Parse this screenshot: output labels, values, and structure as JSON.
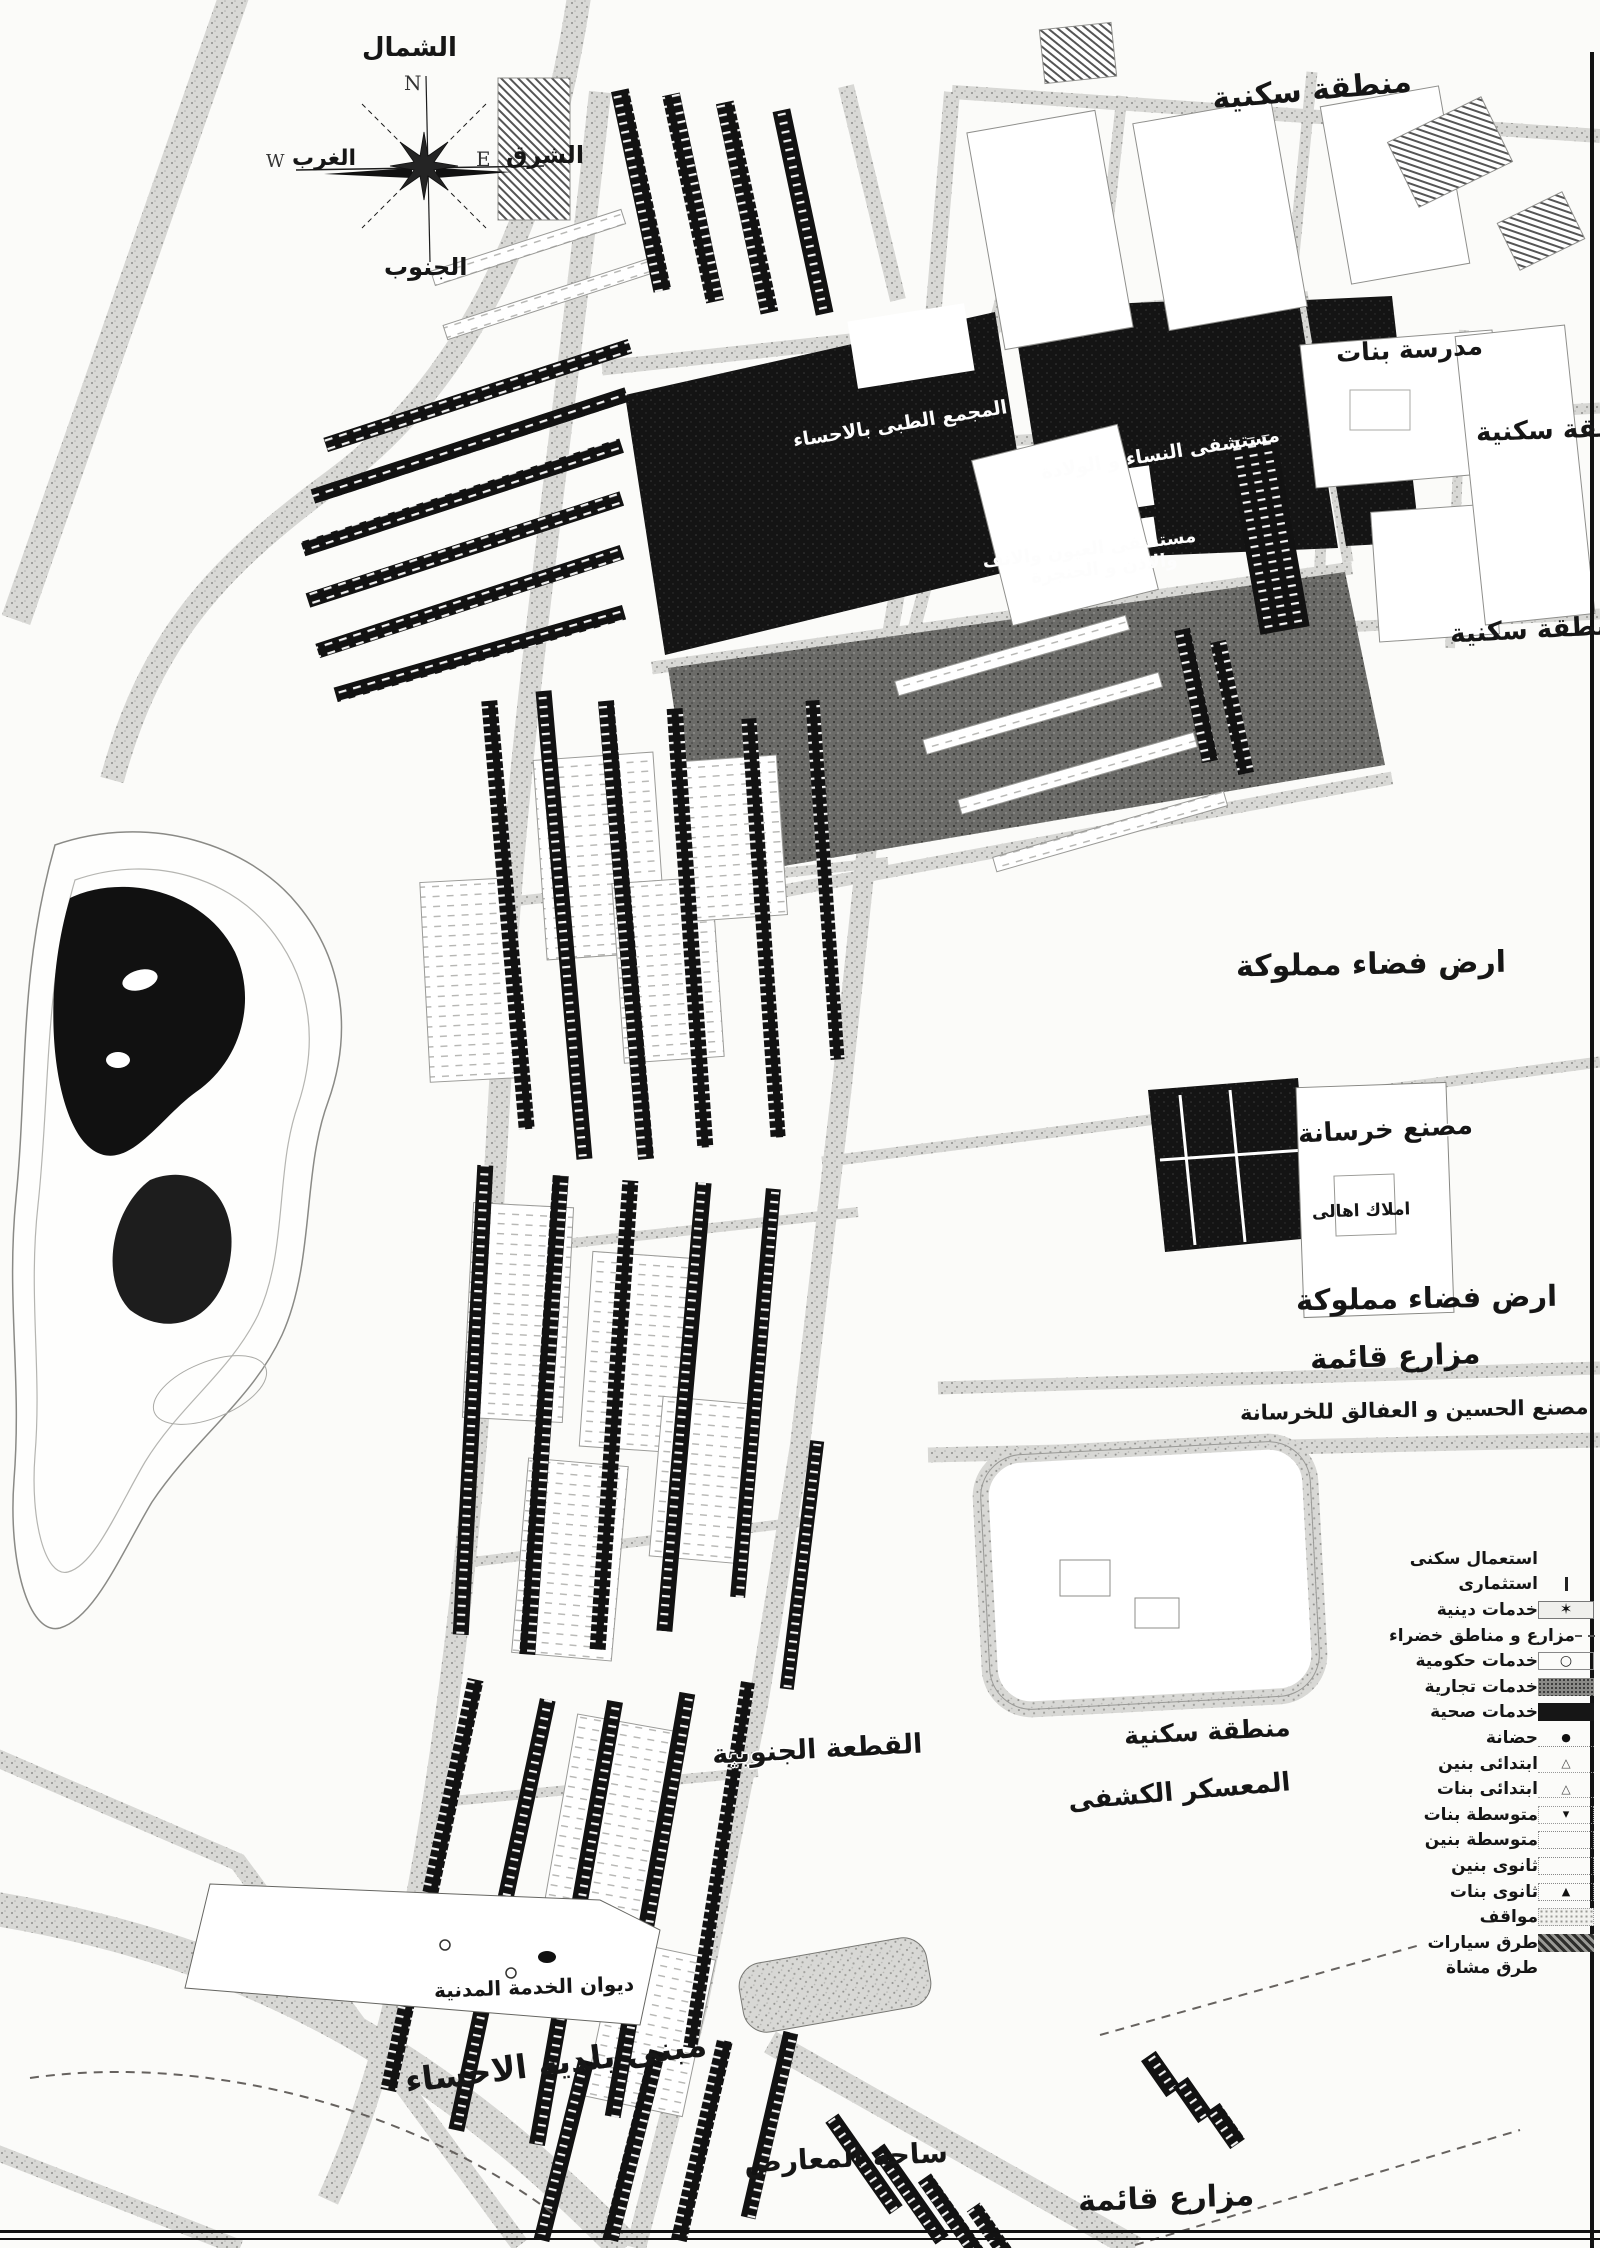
{
  "compass": {
    "north": "الشمال",
    "north_letter": "N",
    "east": "الشرق",
    "east_letter": "E",
    "west": "الغرب",
    "west_letter": "W",
    "south": "الجنوب"
  },
  "labels": {
    "residential_top": "منطقة سكنية",
    "girls_school": "مدرسة بنات",
    "residential_right_upper": "منطقة سكنية",
    "residential_right_lower": "منطقة سكنية",
    "medical_complex": "المجمع الطبى بالاحساء",
    "maternity_hospital": "مستشفى النساء و الولادة",
    "eye_ent_hospital_line1": "مستشفى العيون والانف",
    "eye_ent_hospital_line2": "والاذن و الحنجرة",
    "owned_vacant_land_upper": "ارض فضاء مملوكة",
    "concrete_factory": "مصنع خرسانة",
    "private_properties": "املاك اهالى",
    "owned_vacant_land_lower": "ارض فضاء مملوكة",
    "existing_farms_upper": "مزارع قائمة",
    "hussein_concrete_factory": "مصنع الحسين و العفالق للخرسانة",
    "residential_middle": "منطقة سكنية",
    "scout_camp": "المعسكر الكشفى",
    "southern_parcel": "القطعة الجنوبية",
    "civil_service_bureau": "ديوان الخدمة المدنية",
    "municipality_building": "مبنى بلدية الاحساء",
    "exhibition_grounds": "ساحة المعارض",
    "existing_farms_lower": "مزارع قائمة"
  },
  "legend": {
    "items": [
      {
        "label": "استعمال سكنى",
        "symbol": "blank"
      },
      {
        "label": "استثمارى",
        "symbol": "tick"
      },
      {
        "label": "خدمات دينية",
        "symbol": "mosque-star"
      },
      {
        "label": "مزارع و مناطق خضراء",
        "symbol": "dashed"
      },
      {
        "label": "خدمات حكومية",
        "symbol": "circle"
      },
      {
        "label": "خدمات تجارية",
        "symbol": "dark-speckle"
      },
      {
        "label": "خدمات صحية",
        "symbol": "black"
      },
      {
        "label": "حضانة",
        "symbol": "dot"
      },
      {
        "label": "ابتدائى بنين",
        "symbol": "triangle-outline"
      },
      {
        "label": "ابتدائى بنات",
        "symbol": "triangle-outline"
      },
      {
        "label": "متوسطة بنات",
        "symbol": "triangle-small"
      },
      {
        "label": "متوسطة بنين",
        "symbol": "dotted-rect"
      },
      {
        "label": "ثانوى بنين",
        "symbol": "dotted-rect"
      },
      {
        "label": "ثانوى بنات",
        "symbol": "triangle-filled"
      },
      {
        "label": "مواقف",
        "symbol": "speckle-light"
      },
      {
        "label": "طرق سيارات",
        "symbol": "hatch-heavy"
      },
      {
        "label": "طرق مشاة",
        "symbol": "blank"
      }
    ]
  },
  "colors": {
    "ink": "#141414",
    "road_gray": "#c9c9c6",
    "paper": "#fbfbf9"
  }
}
